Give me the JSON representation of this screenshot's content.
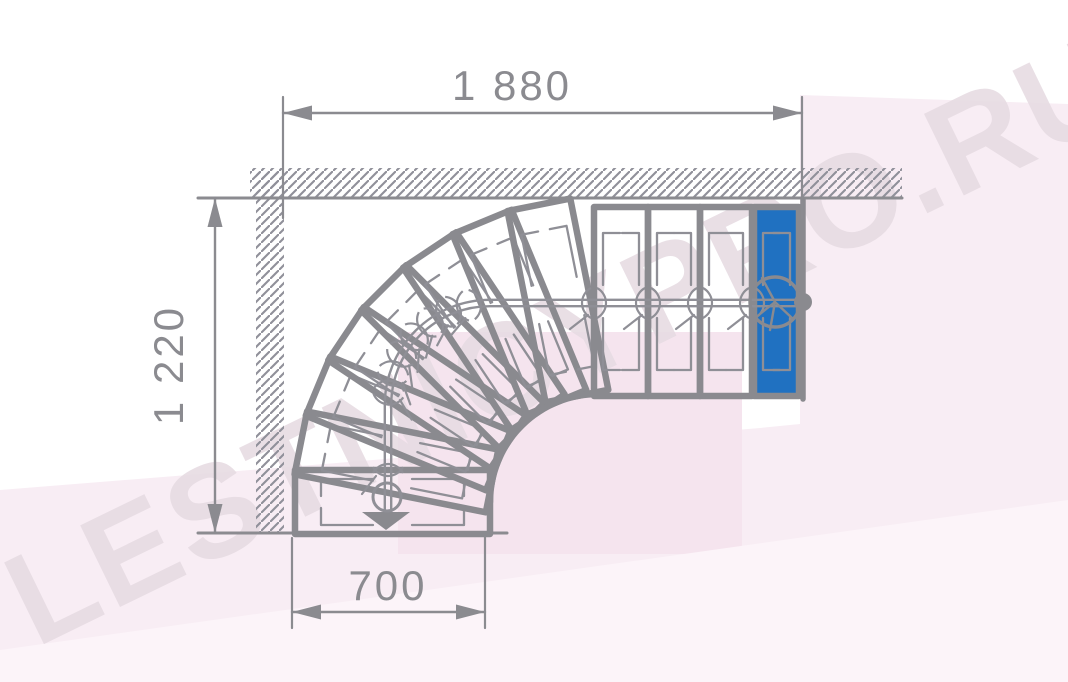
{
  "watermark": {
    "text": "LESTNICYPRO.RU"
  },
  "dimensions": {
    "top": {
      "label": "1 880"
    },
    "left": {
      "label": "1 220"
    },
    "bottom": {
      "label": "700"
    }
  },
  "colors": {
    "background": "#ffffff",
    "stepStroke": "#8a8a8f",
    "thinLine": "#8f8f96",
    "dimLine": "#8b8b90",
    "dimText": "#8b8b90",
    "hatch": "#90909a",
    "blueFill": "#2071c1",
    "pinkMain": "#f8edf4",
    "pinkDeep": "#f5e4ee",
    "pinkLight": "#fcf4f9",
    "watermark": "#e7dce3"
  },
  "geometry": {
    "bg": {
      "p1": [
        [
          0,
          490
        ],
        [
          300,
          466
        ],
        [
          760,
          428
        ],
        [
          800,
          424
        ],
        [
          800,
          95
        ],
        [
          1068,
          104
        ],
        [
          1068,
          682
        ],
        [
          0,
          682
        ]
      ],
      "p3": [
        398,
        332,
        344,
        222
      ],
      "p4": [
        [
          0,
          650
        ],
        [
          1068,
          500
        ],
        [
          1068,
          682
        ],
        [
          0,
          682
        ]
      ]
    },
    "walls": {
      "topHatch": [
        250,
        168,
        652,
        30
      ],
      "leftHatch": [
        256,
        170,
        28,
        363
      ],
      "edges": [
        [
          198,
          198,
          902,
          198,
          3
        ],
        [
          198,
          533,
          507,
          533,
          3
        ]
      ]
    },
    "rightEdge": [
      803,
      200,
      803,
      399,
      5.5
    ],
    "innerArc": {
      "cx": 598,
      "cy": 502,
      "r": 108,
      "a0": 180,
      "a1": 270
    },
    "fan": {
      "cx": 598,
      "cy": 502,
      "r": 108,
      "L": 195,
      "W": 64,
      "count": 8,
      "aStart": 180,
      "aStep": 11.25
    },
    "straight": {
      "yInner": 396,
      "L": 189,
      "xs": [
        [
          594,
          648
        ],
        [
          648,
          700
        ],
        [
          700,
          752
        ],
        [
          754,
          799
        ]
      ]
    },
    "marks": {
      "inset": 9,
      "armLong": 52,
      "armShort": 17,
      "outerOff": 26,
      "innerOff": 26
    },
    "walk": {
      "cx": 490,
      "cy": 405,
      "r": 102,
      "xStart": 806,
      "yH": 303,
      "xV": 388,
      "yEnd": 512,
      "gap": 3.2,
      "arrow": [
        [
          362,
          512
        ],
        [
          410,
          512
        ],
        [
          386,
          530
        ]
      ],
      "circle": {
        "x": 775,
        "y": 302,
        "r": 25
      },
      "smallCircle": {
        "x": 387,
        "y": 497,
        "r": 14
      },
      "dot": {
        "x": 803,
        "y": 302,
        "r": 9
      },
      "branches": [
        [
          775,
          302,
          750,
          322
        ],
        [
          775,
          302,
          770,
          330
        ],
        [
          775,
          302,
          762,
          278
        ],
        [
          775,
          302,
          792,
          318
        ]
      ],
      "ticksStraight": [
        752,
        700,
        648,
        594
      ],
      "ticksArc": [
        258,
        246,
        234,
        222,
        210,
        198,
        187
      ],
      "tickVert": [
        388,
        470
      ]
    },
    "dims": {
      "top": {
        "line": [
          283,
          113,
          802,
          113
        ],
        "exts": [
          [
            283,
            97,
            283,
            218
          ],
          [
            802,
            97,
            802,
            218
          ]
        ],
        "arrows": [
          [
            283,
            113,
            1,
            0
          ],
          [
            802,
            113,
            -1,
            0
          ]
        ]
      },
      "left": {
        "line": [
          215,
          198,
          215,
          533
        ],
        "exts": [],
        "arrows": [
          [
            215,
            198,
            0,
            1
          ],
          [
            215,
            533,
            0,
            -1
          ]
        ]
      },
      "bottom": {
        "line": [
          292,
          612,
          485,
          612
        ],
        "exts": [
          [
            292,
            538,
            292,
            628
          ],
          [
            485,
            536,
            485,
            628
          ]
        ],
        "arrows": [
          [
            292,
            612,
            1,
            0
          ],
          [
            485,
            612,
            -1,
            0
          ]
        ]
      }
    }
  }
}
